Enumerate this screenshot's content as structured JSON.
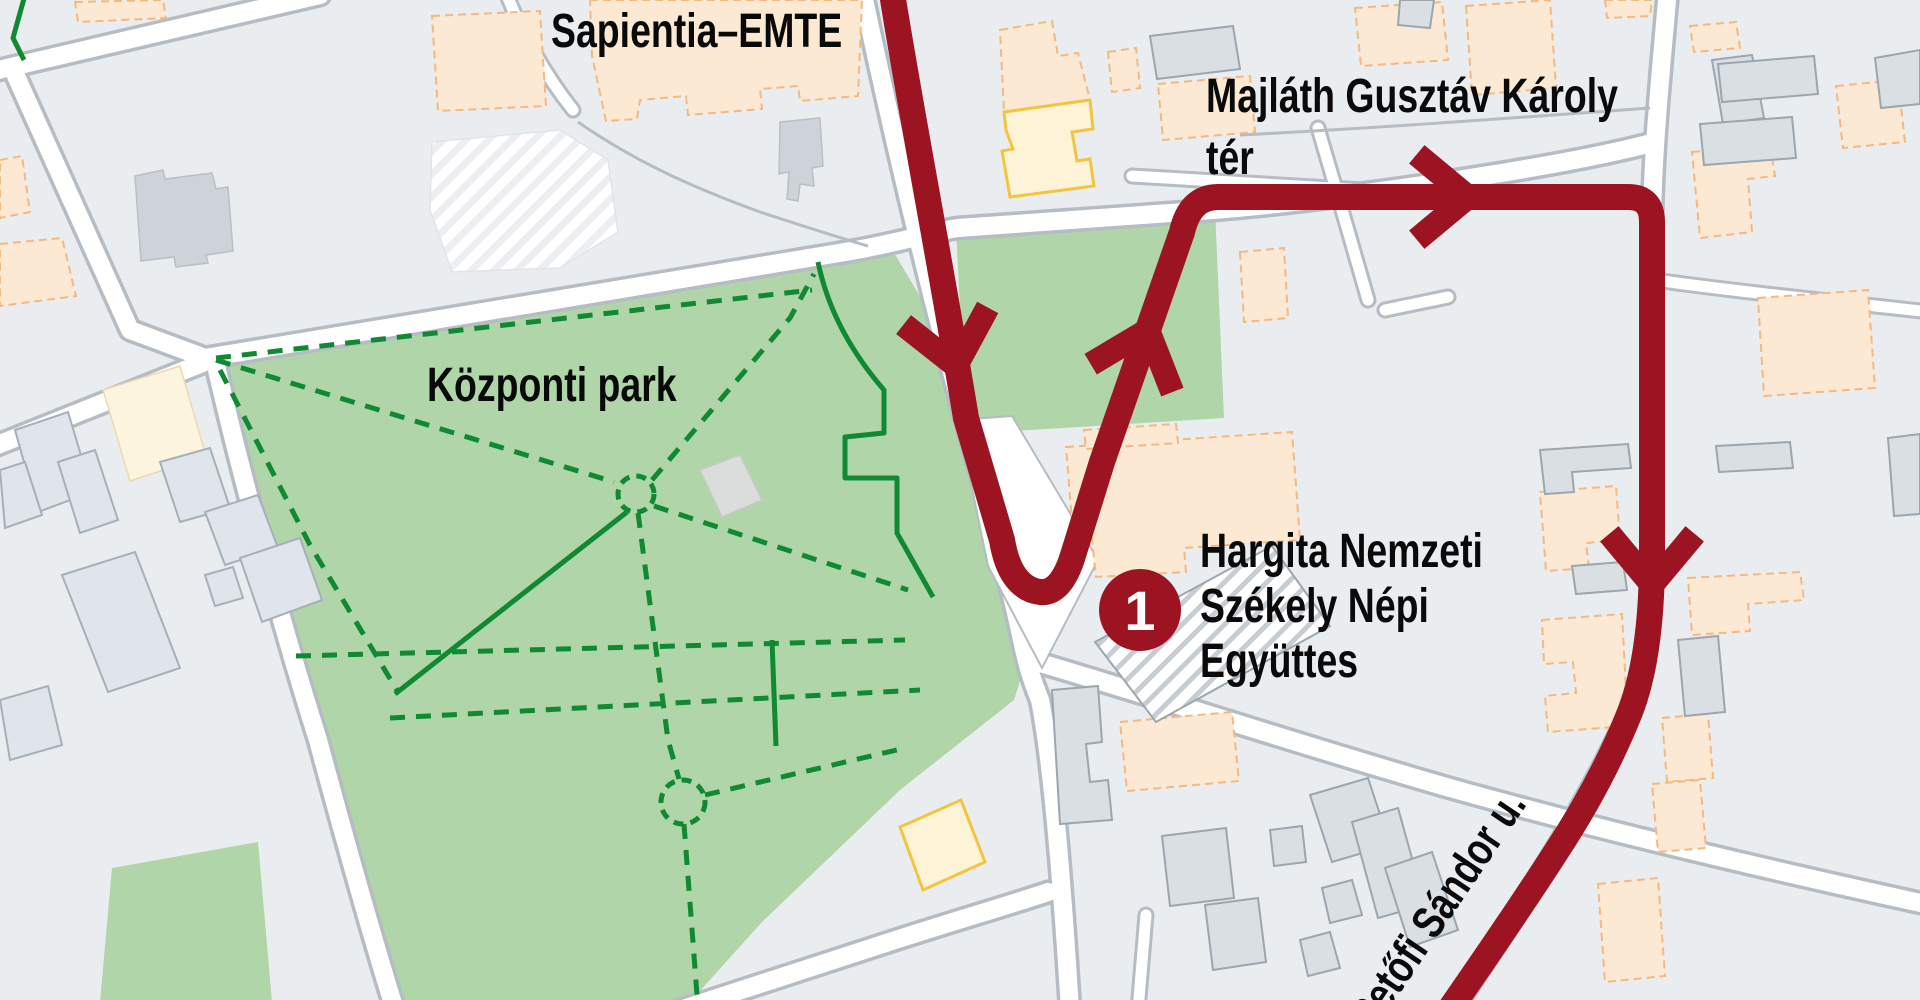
{
  "map": {
    "labels": {
      "university": "Sapientia–EMTE",
      "square_line1": "Majláth Gusztáv Károly",
      "square_line2": "tér",
      "park": "Központi park",
      "poi_line1": "Hargita Nemzeti",
      "poi_line2": "Székely Népi",
      "poi_line3": "Együttes",
      "street": "Petőfi Sándor u."
    },
    "route": {
      "number": "1",
      "color": "#9c1422"
    },
    "colors": {
      "background": "#eaedf0",
      "road_fill": "#ffffff",
      "road_casing": "#b6bcc3",
      "park_green": "#afd5a8",
      "path_green": "#108a32",
      "route_red": "#9c1422",
      "building_peach_fill": "#fbe9d4",
      "building_peach_border": "#f3b97e",
      "building_yellow_fill": "#fdf3d7",
      "building_yellow_border": "#f3c440",
      "building_gray_fill": "#dadfe4",
      "building_gray_border": "#9ba6ae",
      "label_text": "#0a0a0a",
      "badge_text": "#ffffff"
    }
  }
}
